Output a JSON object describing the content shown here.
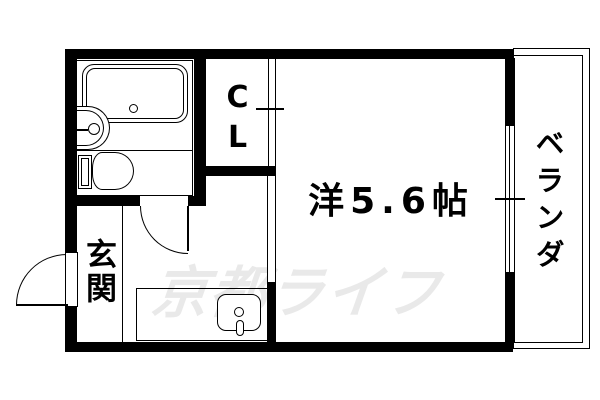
{
  "plan": {
    "rooms": {
      "entrance": "玄関",
      "closet": "CL",
      "main_room": "洋5.6帖",
      "balcony": "ベランダ"
    },
    "watermark": "京都ライフ",
    "colors": {
      "wall": "#000000",
      "watermark": "#e9e9e9",
      "background": "#ffffff"
    }
  }
}
